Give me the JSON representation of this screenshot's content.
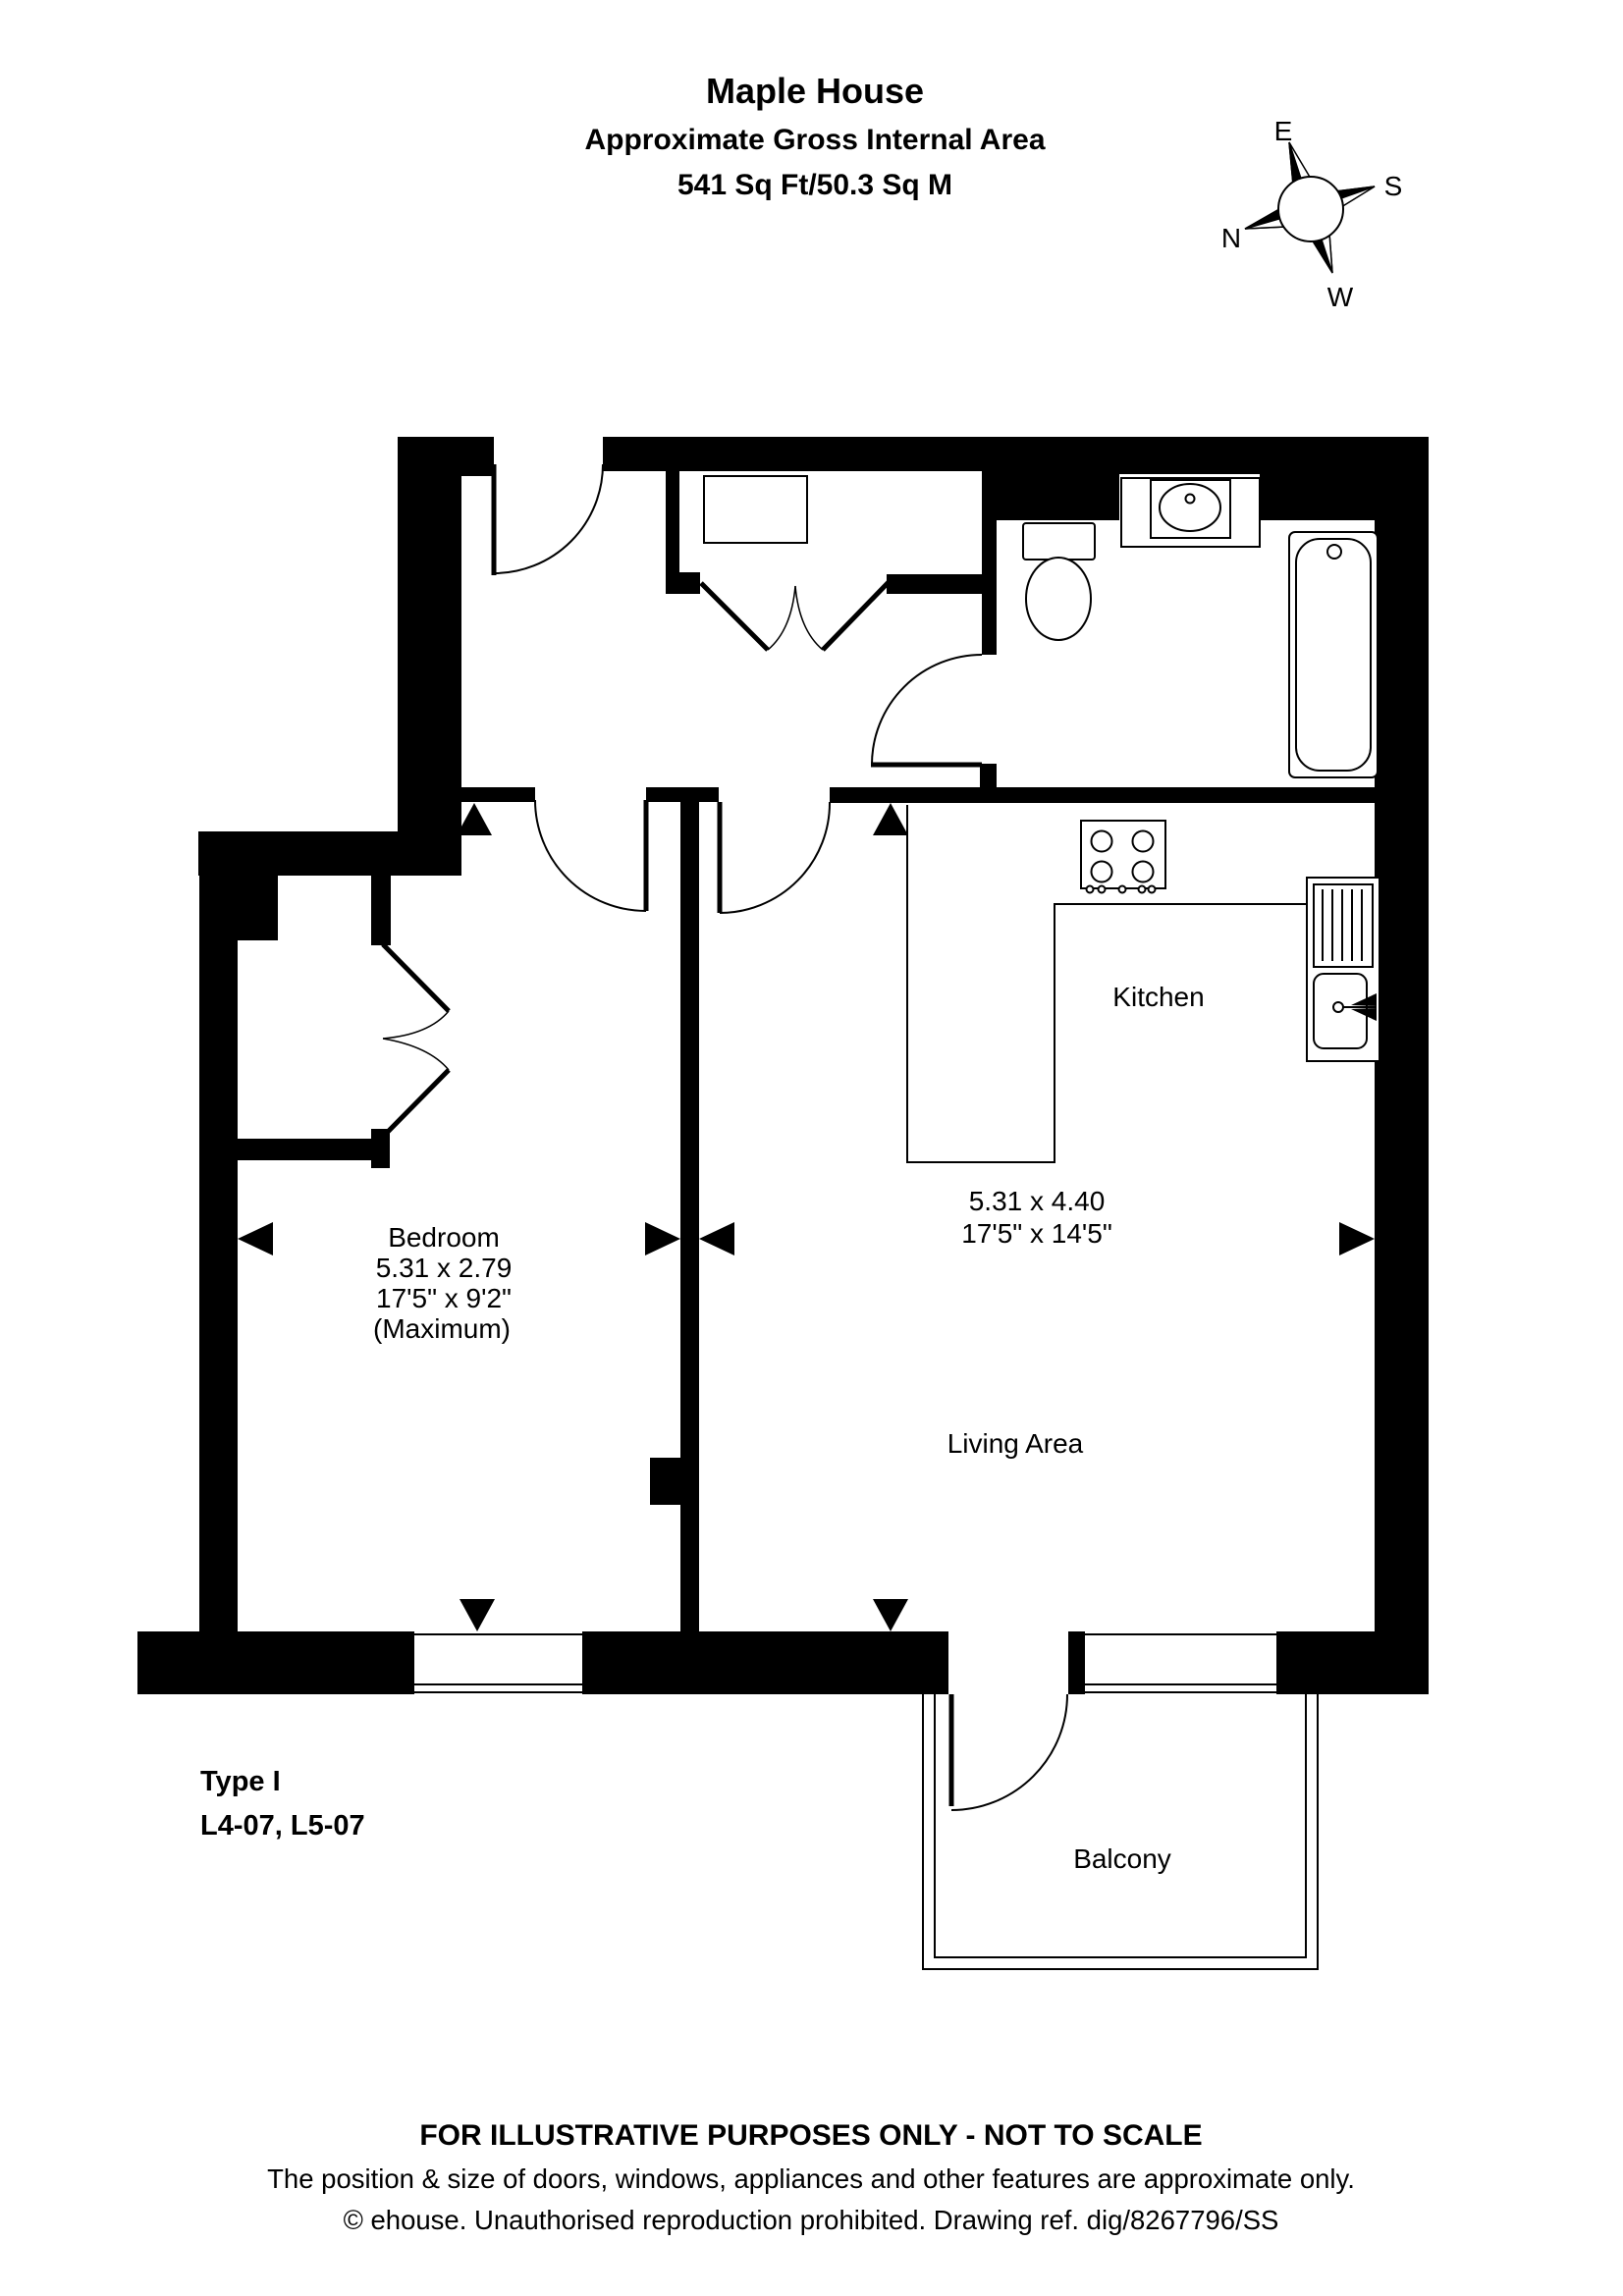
{
  "title": {
    "line1": "Maple House",
    "line2": "Approximate Gross Internal Area",
    "line3": "541 Sq Ft/50.3 Sq M"
  },
  "compass": {
    "e": "E",
    "s": "S",
    "n": "N",
    "w": "W"
  },
  "rooms": {
    "kitchen": {
      "label": "Kitchen"
    },
    "living": {
      "dims_m": "5.31 x 4.40",
      "dims_ft": "17'5\" x 14'5\"",
      "label": "Living Area"
    },
    "bedroom": {
      "label": "Bedroom",
      "dims_m": "5.31 x 2.79",
      "dims_ft": "17'5\" x 9'2\"",
      "note": "(Maximum)"
    },
    "balcony": {
      "label": "Balcony"
    }
  },
  "plan": {
    "type_label": "Type I",
    "units_label": "L4-07, L5-07"
  },
  "footer": {
    "line1": "FOR ILLUSTRATIVE PURPOSES ONLY - NOT TO SCALE",
    "line2": "The position & size of doors, windows, appliances and other features are approximate only.",
    "line3": "© ehouse. Unauthorised reproduction prohibited. Drawing ref. dig/8267796/SS"
  }
}
